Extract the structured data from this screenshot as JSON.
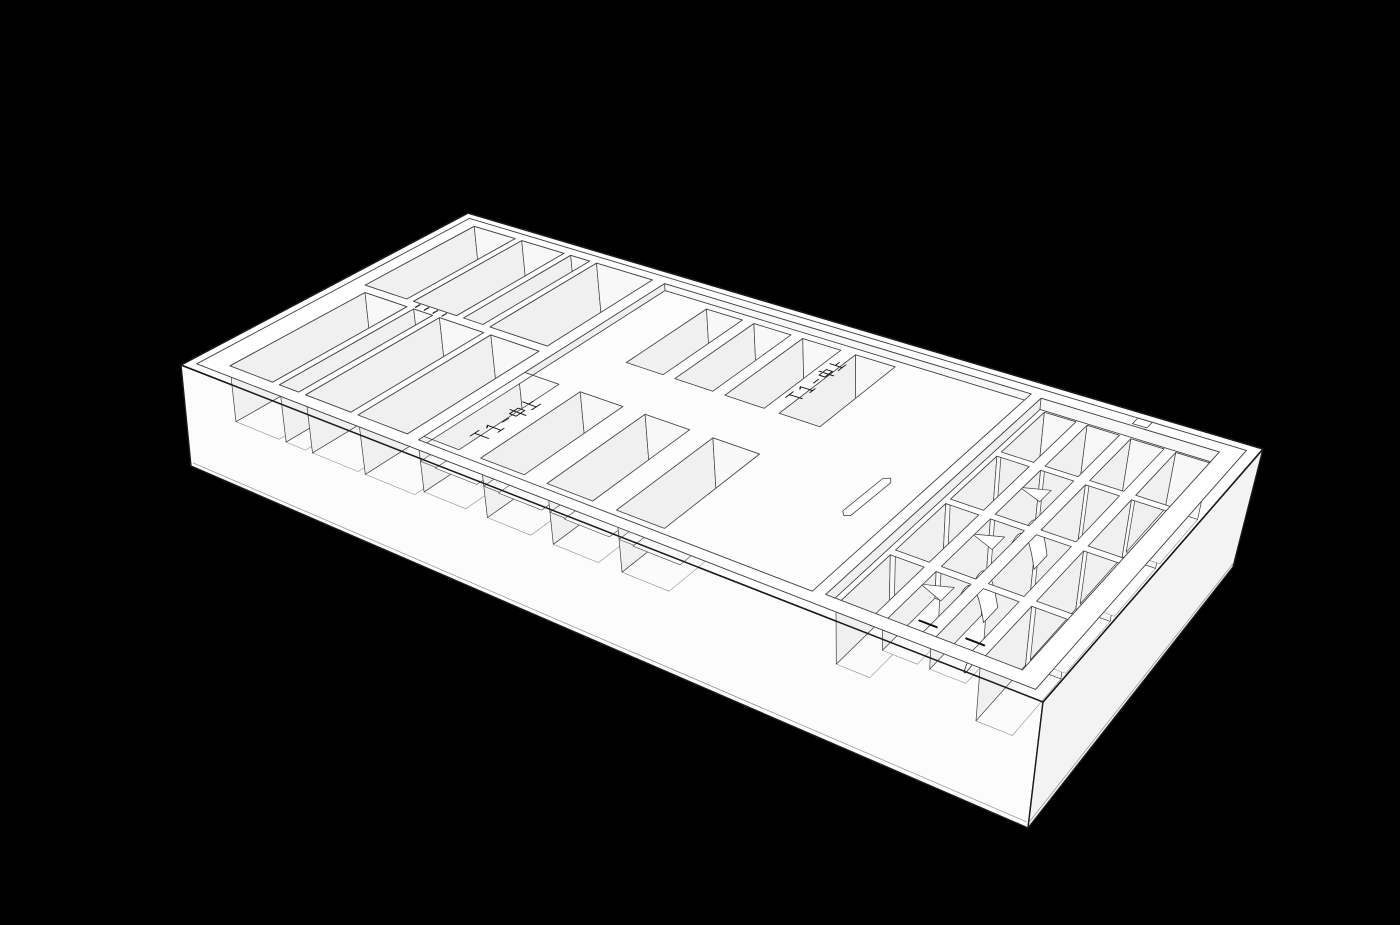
{
  "canvas": {
    "width": 1400,
    "height": 925,
    "background": "#000000"
  },
  "palette": {
    "body_fill": "#ffffff",
    "side_left": "#fcfcfc",
    "side_right": "#f3f3f3",
    "deck": "#ffffff",
    "panel_floor": "#fdfdfd",
    "divider_top": "#ffffff",
    "floor": "#fbfbfb",
    "wall_left": "#f0f0f0",
    "wall_back": "#f8f8f8",
    "pen_floor": "#efefef",
    "outline_strong": "#1b1b1b",
    "outline": "#3f3f3f",
    "outline_soft": "#8f8f8f",
    "engraving": "#151515",
    "slot_dark": "#101010"
  },
  "engravings": [
    {
      "id": "engraving-upper",
      "text": "T1-中上",
      "l": 0.56,
      "w": 0.665,
      "scale": 1.02
    },
    {
      "id": "engraving-lower",
      "text": "T1-中上",
      "l": 0.342,
      "w": 0.15,
      "scale": 1.15
    }
  ],
  "model": {
    "top_corners": [
      [
        181,
        365
      ],
      [
        1043,
        702
      ],
      [
        468,
        213
      ],
      [
        1263,
        449
      ]
    ],
    "bottom_corners": [
      [
        191,
        466
      ],
      [
        1028,
        828
      ],
      [
        477,
        302
      ],
      [
        1233,
        567
      ]
    ],
    "rim_inset_l": 0.012,
    "rim_inset_w": 0.024,
    "bottom_line_d": 0.958,
    "left_slots": {
      "depth": 0.55,
      "back_row": {
        "w": [
          0.535,
          0.945
        ],
        "cols": [
          [
            0.032,
            0.096
          ],
          [
            0.106,
            0.17
          ],
          [
            0.18,
            0.208
          ],
          [
            0.218,
            0.298
          ]
        ]
      },
      "front_row": {
        "w": [
          0.06,
          0.505
        ],
        "cols": [
          [
            0.045,
            0.109
          ],
          [
            0.119,
            0.147
          ],
          [
            0.157,
            0.221
          ],
          [
            0.231,
            0.298
          ]
        ]
      }
    },
    "marks": {
      "l": [
        0.118,
        0.131,
        0.144,
        0.157
      ],
      "w1": 0.514,
      "w2": 0.53
    },
    "panel": {
      "rect": [
        0.315,
        0.055,
        0.77,
        0.945
      ],
      "depth": 0.07,
      "pocket_depth": 0.6,
      "upper_pockets": {
        "w": [
          0.6,
          0.92
        ],
        "cols": [
          [
            0.38,
            0.428
          ],
          [
            0.443,
            0.491
          ],
          [
            0.506,
            0.554
          ],
          [
            0.572,
            0.62
          ]
        ]
      },
      "lower_pockets": {
        "w": [
          0.095,
          0.435
        ],
        "cols": [
          [
            0.295,
            0.35
          ],
          [
            0.378,
            0.433
          ],
          [
            0.461,
            0.516
          ],
          [
            0.544,
            0.599
          ]
        ]
      },
      "step_depths": [
        0.32,
        0.46
      ],
      "step_w": 0.042,
      "pen": {
        "outline": [
          [
            0.7205,
            0.495
          ],
          [
            0.7185,
            0.345
          ],
          [
            0.7235,
            0.332
          ],
          [
            0.7285,
            0.3395
          ],
          [
            0.7305,
            0.4895
          ],
          [
            0.7265,
            0.505
          ]
        ],
        "floor": 0.22,
        "cross_w": 0.468
      },
      "notch": [
        0.878,
        0.948,
        0.893,
        0.976
      ]
    },
    "basin": {
      "rect": [
        0.782,
        0.06,
        0.968,
        0.94
      ],
      "ledge": 0.1,
      "cell_depth": 0.58,
      "shallow_depth": 0.32,
      "col_bounds": [
        0.782,
        0.8285,
        0.875,
        0.9215,
        0.968
      ],
      "row_bounds": [
        0.065,
        0.285,
        0.505,
        0.725,
        0.945
      ],
      "wall_l": 0.006,
      "wall_w": 0.01,
      "shallow_cells": [
        [
          1,
          0
        ],
        [
          2,
          0
        ]
      ],
      "arches": [
        [
          1,
          1
        ],
        [
          1,
          2
        ]
      ],
      "wedges": [
        [
          0,
          1
        ],
        [
          0,
          2
        ],
        [
          0,
          3
        ]
      ],
      "hooks": [
        [
          2,
          0
        ],
        [
          2,
          1
        ],
        [
          2,
          2
        ],
        [
          3,
          1
        ],
        [
          3,
          2
        ],
        [
          3,
          3
        ]
      ],
      "slot_cells": [
        [
          1,
          0
        ],
        [
          2,
          0
        ]
      ]
    }
  }
}
